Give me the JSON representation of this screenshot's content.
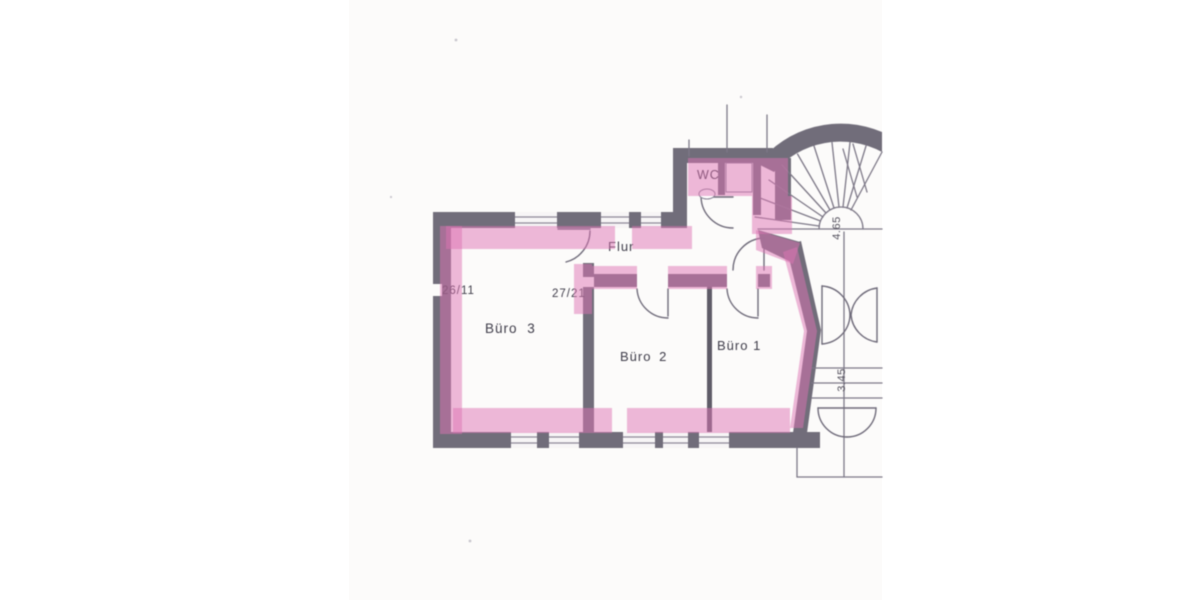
{
  "plan": {
    "rooms": [
      {
        "id": "wc",
        "label": "WC"
      },
      {
        "id": "flur",
        "label": "Flur"
      },
      {
        "id": "buero3",
        "label": "Büro 3"
      },
      {
        "id": "buero2",
        "label": "Büro 2"
      },
      {
        "id": "buero1",
        "label": "Büro 1"
      }
    ],
    "room_codes": [
      {
        "label": "26/11"
      },
      {
        "label": "27/21"
      }
    ],
    "dimensions": [
      {
        "label": "4.65"
      },
      {
        "label": "3.45"
      }
    ],
    "colors": {
      "highlight_pink": "#ecb5d6",
      "wall_gray": "#716d7a",
      "paper_white": "#fcfbfa",
      "ink": "#3e3c49"
    }
  }
}
